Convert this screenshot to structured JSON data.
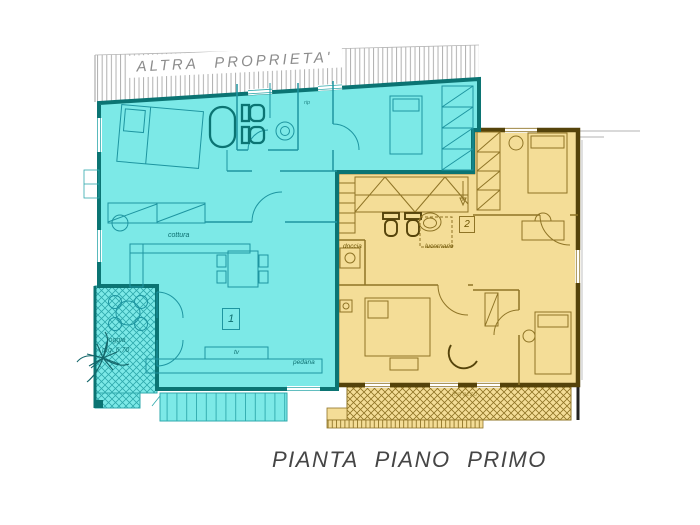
{
  "colors": {
    "cyan-fill": "#7CE9E7",
    "cyan-line": "#1E95A0",
    "cyan-text": "#0D6F70",
    "teal-wall": "#0B7473",
    "yellow-fill": "#F4DD97",
    "yellow-line": "#8F7426",
    "yellow-text": "#6B5200",
    "brown-wall": "#55430A",
    "hatch-gray": "#A8A8A8",
    "label-gray": "#8C8C8C",
    "title-color": "#454545"
  },
  "plan": {
    "title": "PIANTA  PIANO  PRIMO",
    "other_property_label": "ALTRA PROPRIETA'"
  },
  "unit1": {
    "number": "1",
    "labels": {
      "cottura": "cottura",
      "tv": "tv",
      "pedana": "pedana",
      "rip": "rip",
      "loggia_name": "loggia",
      "loggia_area": "mq. 6,70"
    }
  },
  "unit2": {
    "number": "2",
    "labels": {
      "doccia": "doccia",
      "lucernario": "lucernario",
      "terrazzo": "terrazzo"
    }
  }
}
